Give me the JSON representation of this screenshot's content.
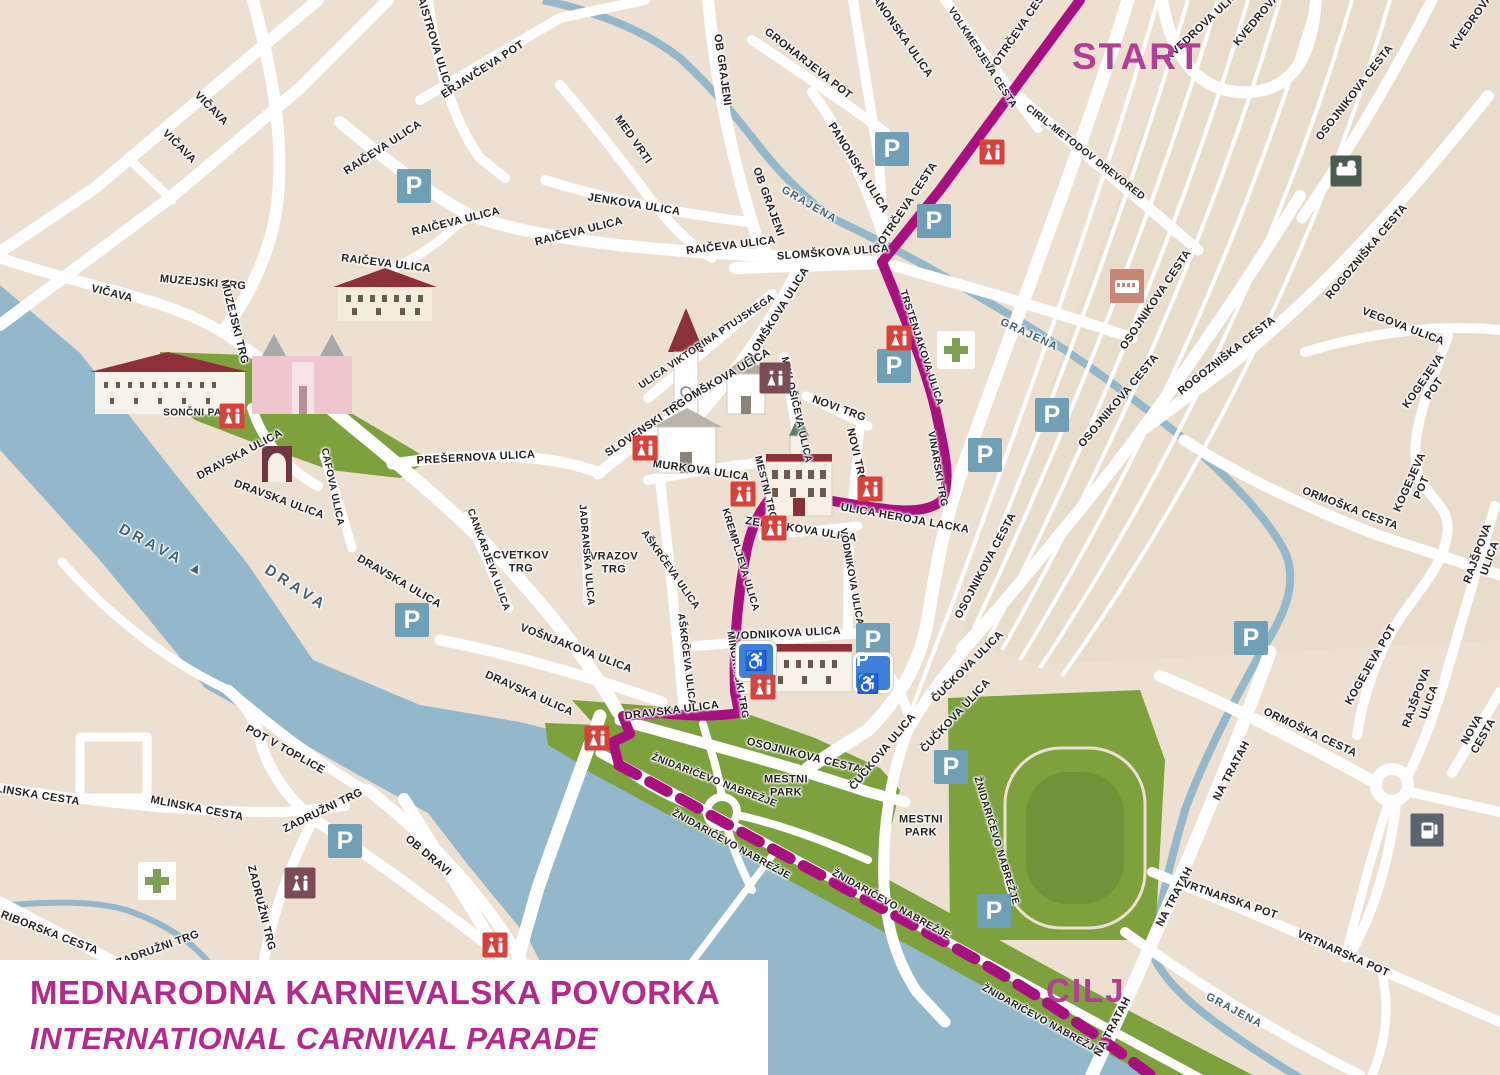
{
  "title": {
    "line1": "MEDNARODNA KARNEVALSKA POVORKA",
    "line2": "INTERNATIONAL CARNIVAL PARADE"
  },
  "route": {
    "start_label": "START",
    "finish_label": "CILJ",
    "color": "#A8107F"
  },
  "colors": {
    "map_bg": "#EDE0D1",
    "road": "#FFFFFF",
    "water": "#93B8CB",
    "park": "#7CA13D",
    "route": "#A8107F",
    "route_endpoint_text": "#B43D96",
    "title_text": "#B5288C",
    "parking": "#6FA0B5",
    "disabled_parking": "#3F80D8",
    "wc_red": "#D9423A",
    "wc_maroon": "#7B4C55",
    "pharmacy_cross": "#7EA052",
    "bus": "#C98776",
    "train": "#4A5B51",
    "fuel": "#5A646E"
  },
  "street_labels": [
    {
      "t": "MAISTROVA ULICA",
      "x": 433,
      "y": 40,
      "r": 73
    },
    {
      "t": "ERJAVČEVA POT",
      "x": 483,
      "y": 70,
      "r": -33
    },
    {
      "t": "VIČAVA",
      "x": 211,
      "y": 109,
      "r": 45
    },
    {
      "t": "VIČAVA",
      "x": 179,
      "y": 147,
      "r": 45
    },
    {
      "t": "VIČAVA",
      "x": 112,
      "y": 294,
      "r": 14
    },
    {
      "t": "MUZEJSKI TRG",
      "x": 203,
      "y": 283,
      "r": 5
    },
    {
      "t": "MUZEJSKI TRG",
      "x": 234,
      "y": 322,
      "r": 76
    },
    {
      "t": "RAIČEVA ULICA",
      "x": 383,
      "y": 148,
      "r": -33
    },
    {
      "t": "RAIČEVA ULICA",
      "x": 456,
      "y": 222,
      "r": -14
    },
    {
      "t": "RAIČEVA ULICA",
      "x": 579,
      "y": 232,
      "r": -14
    },
    {
      "t": "RAIČEVA ULICA",
      "x": 731,
      "y": 246,
      "r": -7
    },
    {
      "t": "RAIČEVA ULICA",
      "x": 386,
      "y": 264,
      "r": 7
    },
    {
      "t": "JENKOVA ULICA",
      "x": 634,
      "y": 205,
      "r": 9
    },
    {
      "t": "MED VRTI",
      "x": 633,
      "y": 140,
      "r": 55
    },
    {
      "t": "OB GRAJENI",
      "x": 722,
      "y": 70,
      "r": 82
    },
    {
      "t": "OB GRAJENI",
      "x": 768,
      "y": 202,
      "r": 70
    },
    {
      "t": "GROHARJEVA POT",
      "x": 808,
      "y": 64,
      "r": 38
    },
    {
      "t": "PANONSKA ULICA",
      "x": 900,
      "y": 34,
      "r": 55
    },
    {
      "t": "PANONSKA ULICA",
      "x": 858,
      "y": 168,
      "r": 58
    },
    {
      "t": "POTRČEVA CESTA",
      "x": 1021,
      "y": 28,
      "r": -56
    },
    {
      "t": "POTRČEVA CESTA",
      "x": 906,
      "y": 207,
      "r": -56
    },
    {
      "t": "VOLKMERJEVA CESTA",
      "x": 982,
      "y": 58,
      "r": 57,
      "fs": 10
    },
    {
      "t": "CIRIL-METODOV DREVORED",
      "x": 1085,
      "y": 153,
      "r": 38,
      "fs": 10
    },
    {
      "t": "KVEDROVA ULICA",
      "x": 1205,
      "y": 24,
      "r": -43
    },
    {
      "t": "KVEDROVA",
      "x": 1257,
      "y": 20,
      "r": -50
    },
    {
      "t": "KVEDROVA",
      "x": 1472,
      "y": 22,
      "r": -55
    },
    {
      "t": "OSOJNIKOVA CESTA",
      "x": 1355,
      "y": 93,
      "r": -52
    },
    {
      "t": "OSOJNIKOVA CESTA",
      "x": 1156,
      "y": 300,
      "r": -56
    },
    {
      "t": "OSOJNIKOVA CESTA",
      "x": 1119,
      "y": 401,
      "r": -50
    },
    {
      "t": "OSOJNIKOVA CESTA",
      "x": 986,
      "y": 566,
      "r": -62
    },
    {
      "t": "ROGOZNIŠKA CESTA",
      "x": 1367,
      "y": 252,
      "r": -50
    },
    {
      "t": "ROGOZNIŠKA CESTA",
      "x": 1227,
      "y": 356,
      "r": -38
    },
    {
      "t": "VEGOVA ULICA",
      "x": 1403,
      "y": 327,
      "r": 21
    },
    {
      "t": "GRAJENA",
      "x": 809,
      "y": 205,
      "r": 30,
      "c": "water"
    },
    {
      "t": "GRAJENA",
      "x": 1029,
      "y": 335,
      "r": 25,
      "c": "water"
    },
    {
      "t": "GRAJENA",
      "x": 1234,
      "y": 1011,
      "r": 28,
      "c": "water"
    },
    {
      "t": "SLOMŠKOVA ULICA",
      "x": 833,
      "y": 253,
      "r": -4
    },
    {
      "t": "SLOMŠKOVA ULICA",
      "x": 777,
      "y": 316,
      "r": -58
    },
    {
      "t": "SLOMŠKOVA ULICA",
      "x": 721,
      "y": 380,
      "r": -30
    },
    {
      "t": "ULICA VIKTORINA PTUJSKEGA",
      "x": 707,
      "y": 342,
      "r": -34,
      "fs": 10
    },
    {
      "t": "SLOVENSKI TRG",
      "x": 646,
      "y": 428,
      "r": -34
    },
    {
      "t": "MIKLOŠIČEVA ULICA",
      "x": 796,
      "y": 410,
      "r": 77,
      "fs": 10
    },
    {
      "t": "NOVI TRG",
      "x": 839,
      "y": 409,
      "r": 20
    },
    {
      "t": "NOVI TRG",
      "x": 856,
      "y": 456,
      "r": 77
    },
    {
      "t": "MURKOVA ULICA",
      "x": 701,
      "y": 471,
      "r": 8
    },
    {
      "t": "TRSTENJAKOVA ULICA",
      "x": 921,
      "y": 348,
      "r": 72,
      "fs": 10
    },
    {
      "t": "VINARSKI TRG",
      "x": 937,
      "y": 469,
      "r": 80,
      "fs": 10
    },
    {
      "t": "ULICA HEROJA LACKA",
      "x": 905,
      "y": 519,
      "r": 10
    },
    {
      "t": "MESTNI TRG",
      "x": 765,
      "y": 488,
      "r": 76,
      "fs": 10
    },
    {
      "t": "KREMPLJEVA ULICA",
      "x": 740,
      "y": 560,
      "r": 73,
      "fs": 10
    },
    {
      "t": "ZELENIKOVA ULICA",
      "x": 801,
      "y": 530,
      "r": 9
    },
    {
      "t": "VODNIKOVA ULICA",
      "x": 851,
      "y": 577,
      "r": 80,
      "fs": 10
    },
    {
      "t": "VODNIKOVA ULICA",
      "x": 787,
      "y": 634,
      "r": -3
    },
    {
      "t": "AŠKRČEVA ULICA",
      "x": 670,
      "y": 570,
      "r": 55,
      "fs": 10
    },
    {
      "t": "AŠKRČEVA ULICA",
      "x": 686,
      "y": 660,
      "r": 83,
      "fs": 10
    },
    {
      "t": "VRAZOV\nTRG",
      "x": 614,
      "y": 563,
      "r": 0
    },
    {
      "t": "CVETKOV\nTRG",
      "x": 521,
      "y": 562,
      "r": 0
    },
    {
      "t": "JADRANSKA ULICA",
      "x": 586,
      "y": 555,
      "r": 85,
      "fs": 10
    },
    {
      "t": "CANKARJEVA ULICA",
      "x": 488,
      "y": 560,
      "r": 70,
      "fs": 10
    },
    {
      "t": "PREŠERNOVA ULICA",
      "x": 476,
      "y": 458,
      "r": -3
    },
    {
      "t": "CAFOVA ULICA",
      "x": 332,
      "y": 487,
      "r": 78,
      "fs": 10
    },
    {
      "t": "DRAVSKA ULICA",
      "x": 240,
      "y": 455,
      "r": -28
    },
    {
      "t": "DRAVSKA ULICA",
      "x": 279,
      "y": 500,
      "r": 20
    },
    {
      "t": "DRAVSKA ULICA",
      "x": 399,
      "y": 582,
      "r": 30
    },
    {
      "t": "DRAVSKA ULICA",
      "x": 529,
      "y": 694,
      "r": 24
    },
    {
      "t": "DRAVSKA ULICA",
      "x": 672,
      "y": 711,
      "r": -7
    },
    {
      "t": "VOŠNJAKOVA ULICA",
      "x": 576,
      "y": 649,
      "r": 21
    },
    {
      "t": "MINORITSKI TRG",
      "x": 737,
      "y": 675,
      "r": 80,
      "fs": 10
    },
    {
      "t": "OSOJNIKOVA CESTA",
      "x": 804,
      "y": 756,
      "r": 14
    },
    {
      "t": "ŽNIDARIČEVO NABREŽJE",
      "x": 714,
      "y": 781,
      "r": 21,
      "fs": 10
    },
    {
      "t": "ŽNIDARIČEVO NABREŽJE",
      "x": 731,
      "y": 845,
      "r": 29,
      "fs": 10
    },
    {
      "t": "ŽNIDARIČEVO NABREŽJE",
      "x": 891,
      "y": 905,
      "r": 29,
      "fs": 10
    },
    {
      "t": "ŽNIDARIČEVO NABREŽJE",
      "x": 1041,
      "y": 1020,
      "r": 29,
      "fs": 10
    },
    {
      "t": "ŽNIDARIČEVO NABREŽJE",
      "x": 996,
      "y": 841,
      "r": 73,
      "fs": 10
    },
    {
      "t": "MESTNI\nPARK",
      "x": 786,
      "y": 786,
      "r": 0
    },
    {
      "t": "MESTNI\nPARK",
      "x": 921,
      "y": 826,
      "r": 0
    },
    {
      "t": "ČUČKOVA ULICA",
      "x": 968,
      "y": 667,
      "r": -45
    },
    {
      "t": "ČUČKOVA ULICA",
      "x": 956,
      "y": 716,
      "r": -47
    },
    {
      "t": "ČUČKOVA ULICA",
      "x": 883,
      "y": 752,
      "r": -50
    },
    {
      "t": "POT V TOPLICE",
      "x": 285,
      "y": 750,
      "r": 29
    },
    {
      "t": "MLINSKA CESTA",
      "x": 33,
      "y": 795,
      "r": 9
    },
    {
      "t": "MLINSKA CESTA",
      "x": 197,
      "y": 809,
      "r": 11
    },
    {
      "t": "ZADRUŽNI TRG",
      "x": 323,
      "y": 811,
      "r": -26
    },
    {
      "t": "ZADRUŽNI TRG",
      "x": 261,
      "y": 908,
      "r": 76
    },
    {
      "t": "ZADRUŽNI TRG",
      "x": 158,
      "y": 949,
      "r": -20
    },
    {
      "t": "MARIBORSKA CESTA",
      "x": 41,
      "y": 930,
      "r": 21
    },
    {
      "t": "OB DRAVI",
      "x": 428,
      "y": 856,
      "r": 40
    },
    {
      "t": "ORMOŠKA CESTA",
      "x": 1350,
      "y": 509,
      "r": 21
    },
    {
      "t": "ORMOŠKA CESTA",
      "x": 1310,
      "y": 733,
      "r": 25
    },
    {
      "t": "KOGEJEVA POT",
      "x": 1429,
      "y": 385,
      "r": -55
    },
    {
      "t": "KOGEJEVA POT",
      "x": 1416,
      "y": 485,
      "r": -66
    },
    {
      "t": "KOGEJEVA POT",
      "x": 1371,
      "y": 665,
      "r": -60
    },
    {
      "t": "RAJŠPOVA ULICA",
      "x": 1484,
      "y": 556,
      "r": -70
    },
    {
      "t": "RAJŠPOVA ULICA",
      "x": 1423,
      "y": 700,
      "r": -70
    },
    {
      "t": "NOVA CESTA",
      "x": 1478,
      "y": 733,
      "r": -60
    },
    {
      "t": "NA TRATAH",
      "x": 1232,
      "y": 771,
      "r": -62
    },
    {
      "t": "NA TRATAH",
      "x": 1175,
      "y": 897,
      "r": -62
    },
    {
      "t": "NA TRATAH",
      "x": 1113,
      "y": 1027,
      "r": -62
    },
    {
      "t": "VRTNARSKA POT",
      "x": 1230,
      "y": 900,
      "r": 19
    },
    {
      "t": "VRTNARSKA POT",
      "x": 1343,
      "y": 954,
      "r": 24
    },
    {
      "t": "SONČNI PARK",
      "x": 200,
      "y": 413,
      "r": 0,
      "fs": 10
    },
    {
      "t": "DRAVA  ▲",
      "x": 163,
      "y": 551,
      "r": 28,
      "c": "water-big"
    },
    {
      "t": "DRAVA",
      "x": 296,
      "y": 588,
      "r": 33,
      "c": "water-big"
    }
  ],
  "poi_icons": [
    {
      "type": "parking",
      "x": 414,
      "y": 186
    },
    {
      "type": "parking",
      "x": 892,
      "y": 149
    },
    {
      "type": "parking",
      "x": 934,
      "y": 221
    },
    {
      "type": "parking",
      "x": 894,
      "y": 366
    },
    {
      "type": "parking",
      "x": 1052,
      "y": 415
    },
    {
      "type": "parking",
      "x": 985,
      "y": 455
    },
    {
      "type": "parking",
      "x": 873,
      "y": 640
    },
    {
      "type": "parking",
      "x": 412,
      "y": 620
    },
    {
      "type": "parking",
      "x": 951,
      "y": 767
    },
    {
      "type": "parking",
      "x": 994,
      "y": 911
    },
    {
      "type": "parking",
      "x": 1251,
      "y": 638
    },
    {
      "type": "parking",
      "x": 345,
      "y": 841
    },
    {
      "type": "parking-disabled",
      "x": 756,
      "y": 661
    },
    {
      "type": "parking-disabled",
      "x": 873,
      "y": 673,
      "variant": "p"
    },
    {
      "type": "wc",
      "x": 992,
      "y": 152,
      "variant": "red"
    },
    {
      "type": "wc",
      "x": 899,
      "y": 338,
      "variant": "red"
    },
    {
      "type": "wc",
      "x": 232,
      "y": 416,
      "variant": "red"
    },
    {
      "type": "wc",
      "x": 645,
      "y": 448,
      "variant": "red"
    },
    {
      "type": "wc",
      "x": 743,
      "y": 494,
      "variant": "red"
    },
    {
      "type": "wc",
      "x": 870,
      "y": 489,
      "variant": "red"
    },
    {
      "type": "wc",
      "x": 774,
      "y": 528,
      "variant": "red"
    },
    {
      "type": "wc",
      "x": 763,
      "y": 687,
      "variant": "red"
    },
    {
      "type": "wc",
      "x": 597,
      "y": 738,
      "variant": "red"
    },
    {
      "type": "wc",
      "x": 495,
      "y": 945,
      "variant": "red"
    },
    {
      "type": "wc",
      "x": 775,
      "y": 378,
      "variant": "maroon"
    },
    {
      "type": "wc",
      "x": 300,
      "y": 883,
      "variant": "maroon"
    },
    {
      "type": "pharmacy",
      "x": 956,
      "y": 350
    },
    {
      "type": "pharmacy",
      "x": 157,
      "y": 881
    },
    {
      "type": "bus",
      "x": 1127,
      "y": 286
    },
    {
      "type": "train",
      "x": 1346,
      "y": 171
    },
    {
      "type": "fuel",
      "x": 1427,
      "y": 830
    }
  ]
}
